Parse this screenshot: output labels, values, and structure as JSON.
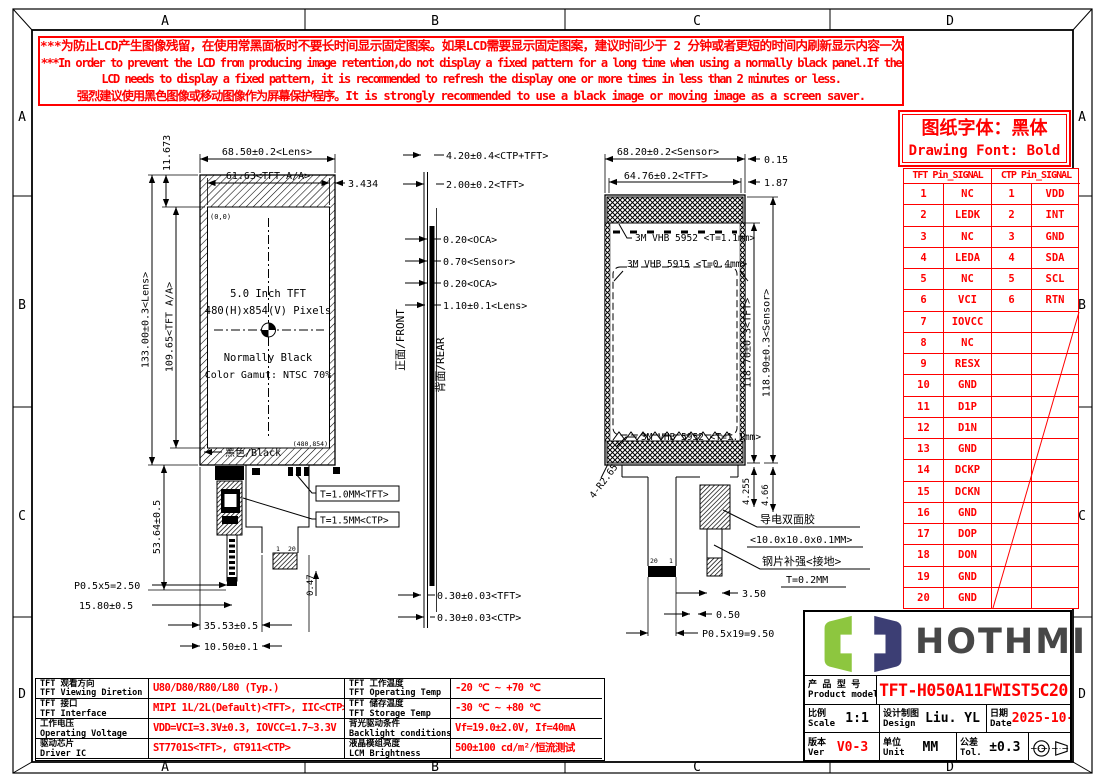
{
  "frame": {
    "zones": [
      "A",
      "B",
      "C",
      "D"
    ]
  },
  "warning": {
    "line1": "***为防止LCD产生图像残留，在使用常黑面板时不要长时间显示固定图案。如果LCD需要显示固定图案，建议时间少于 2 分钟或者更短的时间内刷新显示内容一次或多次。",
    "line2": "***In order to prevent the LCD from producing image retention,do not display a fixed pattern for a long time when using a normally black panel.If the",
    "line3": "LCD needs to display a fixed pattern, it is recommended to refresh the display one or more times in less than 2 minutes or less.",
    "line4": "强烈建议使用黑色图像或移动图像作为屏幕保护程序。It is strongly recommended to use a black image or moving image as a screen saver."
  },
  "font_note": {
    "cn": "图纸字体：黑体",
    "en": "Drawing Font: Bold"
  },
  "pin_table": {
    "header_tft": "TFT Pin_SIGNAL",
    "header_ctp": "CTP Pin_SIGNAL",
    "rows": [
      {
        "t": "1",
        "ts": "NC",
        "c": "1",
        "cs": "VDD"
      },
      {
        "t": "2",
        "ts": "LEDK",
        "c": "2",
        "cs": "INT"
      },
      {
        "t": "3",
        "ts": "NC",
        "c": "3",
        "cs": "GND"
      },
      {
        "t": "4",
        "ts": "LEDA",
        "c": "4",
        "cs": "SDA"
      },
      {
        "t": "5",
        "ts": "NC",
        "c": "5",
        "cs": "SCL"
      },
      {
        "t": "6",
        "ts": "VCI",
        "c": "6",
        "cs": "RTN"
      },
      {
        "t": "7",
        "ts": "IOVCC",
        "c": "",
        "cs": ""
      },
      {
        "t": "8",
        "ts": "NC",
        "c": "",
        "cs": ""
      },
      {
        "t": "9",
        "ts": "RESX",
        "c": "",
        "cs": ""
      },
      {
        "t": "10",
        "ts": "GND",
        "c": "",
        "cs": ""
      },
      {
        "t": "11",
        "ts": "D1P",
        "c": "",
        "cs": ""
      },
      {
        "t": "12",
        "ts": "D1N",
        "c": "",
        "cs": ""
      },
      {
        "t": "13",
        "ts": "GND",
        "c": "",
        "cs": ""
      },
      {
        "t": "14",
        "ts": "DCKP",
        "c": "",
        "cs": ""
      },
      {
        "t": "15",
        "ts": "DCKN",
        "c": "",
        "cs": ""
      },
      {
        "t": "16",
        "ts": "GND",
        "c": "",
        "cs": ""
      },
      {
        "t": "17",
        "ts": "DOP",
        "c": "",
        "cs": ""
      },
      {
        "t": "18",
        "ts": "DON",
        "c": "",
        "cs": ""
      },
      {
        "t": "19",
        "ts": "GND",
        "c": "",
        "cs": ""
      },
      {
        "t": "20",
        "ts": "GND",
        "c": "",
        "cs": ""
      }
    ]
  },
  "views": {
    "front": {
      "lens_w": "68.50±0.2<Lens>",
      "aa_w": "61.63<TFT A/A>",
      "off_r": "3.434",
      "off_t": "11.673",
      "lens_h": "133.00±0.3<Lens>",
      "aa_h": "109.65<TFT A/A>",
      "fpc_h": "53.64±0.5",
      "origin": "(0,0)",
      "l1": "5.0 Inch TFT",
      "l2": "480(H)x854(V) Pixels",
      "l3": "Normally Black",
      "l4": "Color Gamut: NTSC 70%",
      "black": "黑色/Black",
      "endc": "(480,854)",
      "t_tft": "T=1.0MM<TFT>",
      "t_ctp": "T=1.5MM<CTP>",
      "p05": "P0.5x5=2.50",
      "d1580": "15.80±0.5",
      "d3553": "35.53±0.5",
      "d1050": "10.50±0.1",
      "d047": "0.47",
      "pin1": "1",
      "pin20": "20"
    },
    "side": {
      "front_lab": "正面/FRONT",
      "rear_lab": "背面/REAR",
      "d420": "4.20±0.4<CTP+TFT>",
      "d200": "2.00±0.2<TFT>",
      "oca1": "0.20<OCA>",
      "sensor": "0.70<Sensor>",
      "oca2": "0.20<OCA>",
      "lens": "1.10±0.1<Lens>",
      "tft030": "0.30±0.03<TFT>",
      "ctp030": "0.30±0.03<CTP>"
    },
    "rear": {
      "sensor_w": "68.20±0.2<Sensor>",
      "tft_w": "64.76±0.2<TFT>",
      "d015": "0.15",
      "d187": "1.87",
      "vhb1": "3M VHB 5952 <T=1.1mm>",
      "vhb2": "3M VHB 5915 <T=0.4mm>",
      "vhb3": "3M VHB 5952 <T=1.1mm>",
      "tft_h": "118.70±0.3<TFT>",
      "sensor_h": "118.90±0.3<Sensor>",
      "d4255": "4.255",
      "d466": "4.66",
      "radius": "4-R2.65",
      "tape": "导电双面胶",
      "tape_sz": "<10.0x10.0x0.1MM>",
      "steel": "钢片补强<接地>",
      "steel_t": "T=0.2MM",
      "d350": "3.50",
      "d050": "0.50",
      "p0519": "P0.5x19=9.50",
      "pin20": "20",
      "pin1": "1"
    }
  },
  "spec_table": {
    "rows": [
      {
        "label_cn": "TFT 观看方向",
        "label_en": "TFT Viewing Diretion",
        "value": "U80/D80/R80/L80 (Typ.)",
        "label2_cn": "TFT 工作温度",
        "label2_en": "TFT Operating Temp",
        "value2": "-20 ℃ ~ +70 ℃"
      },
      {
        "label_cn": "TFT 接口",
        "label_en": "TFT Interface",
        "value": "MIPI 1L/2L(Default)<TFT>, IIC<CTP>",
        "label2_cn": "TFT 储存温度",
        "label2_en": "TFT Storage Temp",
        "value2": "-30 ℃ ~ +80 ℃"
      },
      {
        "label_cn": "工作电压",
        "label_en": "Operating Voltage",
        "value": "VDD=VCI=3.3V±0.3, IOVCC=1.7~3.3V",
        "label2_cn": "背光驱动条件",
        "label2_en": "Backlight conditions",
        "value2": "Vf=19.0±2.0V, If=40mA"
      },
      {
        "label_cn": "驱动芯片",
        "label_en": "Driver IC",
        "value": "ST7701S<TFT>, GT911<CTP>",
        "label2_cn": "液晶模组亮度",
        "label2_en": "LCM Brightness",
        "value2": "500±100 cd/m²/恒流测试"
      }
    ]
  },
  "title_block": {
    "logo_text": "HOTHMI",
    "product_cn": "产 品 型 号",
    "product_en": "Product model",
    "model": "TFT-H050A11FWIST5C20",
    "scale_cn": "比例",
    "scale_en": "Scale",
    "scale_val": "1:1",
    "design_cn": "设计制图",
    "design_en": "Design",
    "design_val": "Liu. YL",
    "date_cn": "日期",
    "date_en": "Date",
    "date_val": "2025-10-29",
    "ver_cn": "版本",
    "ver_en": "Ver",
    "ver_val": "V0-3",
    "unit_cn": "单位",
    "unit_en": "Unit",
    "unit_val": "MM",
    "tol_cn": "公差",
    "tol_en": "Tol.",
    "tol_val": "±0.3"
  },
  "colors": {
    "accent_red": "#ff0000",
    "logo_green": "#8dc63f",
    "logo_navy": "#3c3e74",
    "logo_gray": "#474747"
  }
}
